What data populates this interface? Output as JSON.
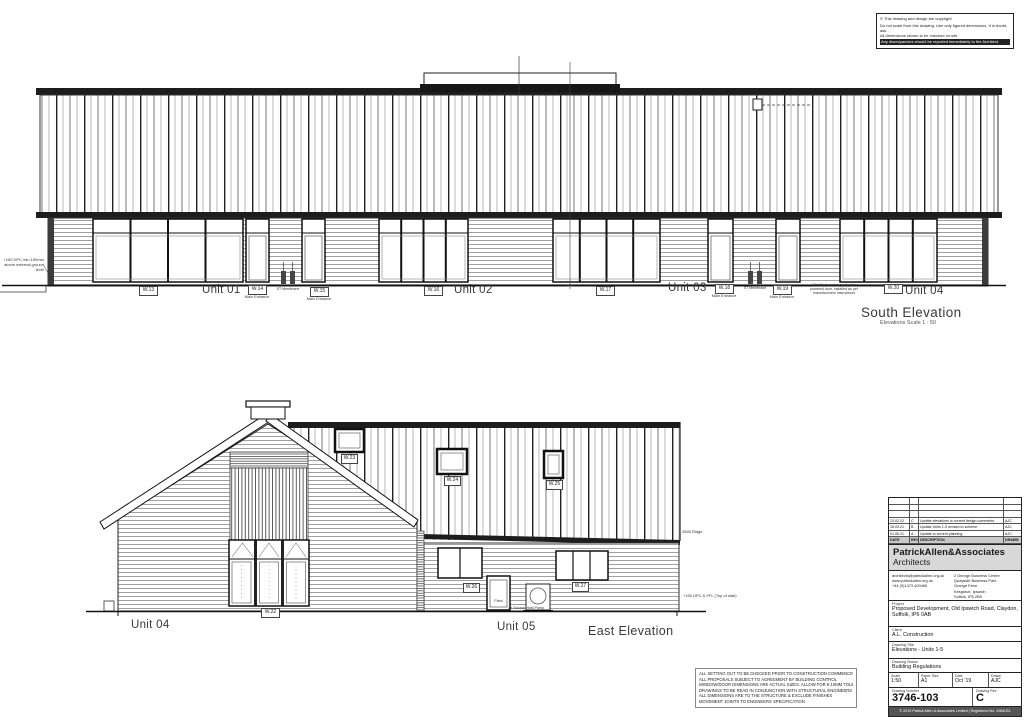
{
  "copyright_box": {
    "line1": "© This drawing and design are copyright",
    "line2": "Do not scale from this drawing. Use only figured dimensions. If in doubt, ask.",
    "line3": "All dimensions shown to be checked on site.",
    "line4": "Any discrepancies should be reported immediately to the Architect."
  },
  "south": {
    "title": "South Elevation",
    "subtitle": "Elevations  Scale 1 : 50",
    "units": [
      "Unit 01",
      "Unit 02",
      "Unit 03",
      "Unit 04"
    ],
    "tags": {
      "w13": "W.13",
      "w14": "W.14",
      "w15": "W.15",
      "w16": "W.16",
      "w17": "W.17",
      "w18": "W.18",
      "w19": "W.19",
      "w20": "W.20"
    },
    "main_entrance": "Main Entrance",
    "membrane_note": "ST Membrane",
    "access_note": "Disabled access push pad powered door, installed as per manufacturers instructions",
    "dpc_note": "+150 DPC min 150mm above external ground level"
  },
  "east": {
    "title": "East Elevation",
    "units": [
      "Unit 04",
      "Unit 05"
    ],
    "tags": {
      "w22": "W.22",
      "w23": "W.23",
      "w24": "W.24",
      "w25": "W.25",
      "w26": "W.26",
      "w27": "W.27"
    },
    "heat_pump_note": "Air Source Heat Pump",
    "door_note": "Plant",
    "ridge_note": "2845  Ridge",
    "dpc_note": "+150  DPC & FFL (Top of slab)"
  },
  "site_notes": {
    "lines": [
      "ALL SETTING OUT TO BE CHECKED PRIOR TO CONSTRUCTION COMMENCING",
      "ALL PROPOSALS SUBJECT TO AGREEMENT BY BUILDING CONTROL",
      "WINDOW/DOOR DIMENSIONS ARE ACTUAL SIZES. ALLOW FOR 6-10MM TOLERANCE",
      "DRAWINGS TO BE READ IN CONJUNCTION WITH STRUCTURAL ENGINEERS DRAWINGS",
      "ALL DIMENSIONS ARE TO THE STRUCTURE & EXCLUDE FINISHES",
      "MOVEMENT JOINTS TO ENGINEERS SPECIFICATION"
    ]
  },
  "title_block": {
    "revisions": [
      {
        "date": "23.02.22",
        "rev": "C",
        "desc": "Update elevations to current design comments",
        "by": "AJC"
      },
      {
        "date": "16.09.21",
        "rev": "B",
        "desc": "Update Units 1-5 revised to scheme",
        "by": "AJC"
      },
      {
        "date": "01.06.21",
        "rev": "A",
        "desc": "Update to current planning",
        "by": "AJC"
      }
    ],
    "rev_header": {
      "date": "DATE",
      "rev": "REV",
      "desc": "DESCRIPTION",
      "by": "DRAWN"
    },
    "firm_name": "PatrickAllen&Associates",
    "firm_sub": "Architects",
    "contact_left": [
      "architects@patrickallen.org.uk",
      "www.patrickallen.org.uk",
      "+44 (0)1473 400460"
    ],
    "contact_right": [
      "2 George Business Centre",
      "Quayside Business Park",
      "Grange Farm",
      "Kesgrave, Ipswich",
      "Suffolk, IP5 2BX"
    ],
    "project_label": "Project",
    "project": "Proposed Development, Old Ipswich Road, Claydon, Suffolk, IP6 0AB",
    "client_label": "Client",
    "client": "A.L. Construction",
    "drawing_title_label": "Drawing Title",
    "drawing_title": "Elevations - Units 1-5",
    "status_label": "Drawing Status",
    "status": "Building Regulations",
    "scale_label": "Scale",
    "scale": "1:50",
    "paper_label": "Paper Size",
    "paper": "A1",
    "date_label": "Date",
    "date": "Oct '19",
    "drawn_label": "Drawn",
    "drawn": "AJC",
    "number_label": "Drawing Number",
    "number": "3746-103",
    "rev_label": "Drawing Rev",
    "rev": "C",
    "footer": "© 2019 Patrick Allen & Associates Limited   |   Registered No: 4984031"
  }
}
